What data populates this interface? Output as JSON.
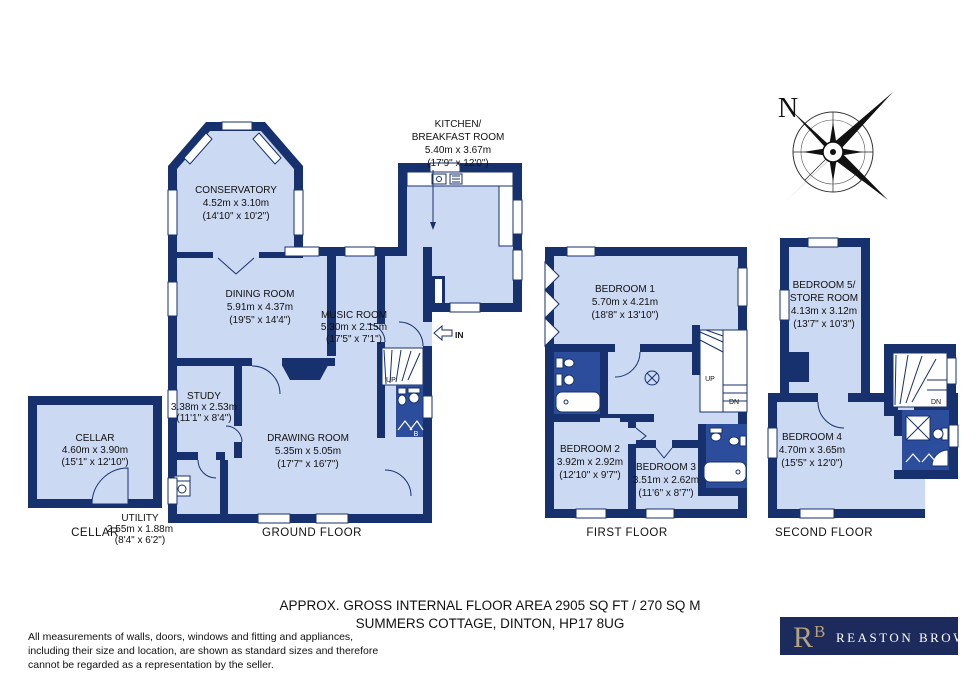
{
  "meta": {
    "footer1": "APPROX. GROSS INTERNAL FLOOR AREA 2905 SQ FT / 270 SQ M",
    "footer2": "SUMMERS COTTAGE, DINTON, HP17 8UG",
    "disc1": "All measurements of walls, doors, windows and fitting and appliances,",
    "disc2": "including their size and location, are shown as standard sizes and therefore",
    "disc3": "cannot be regarded as a representation by the seller."
  },
  "colors": {
    "wall": "#16316e",
    "room": "#ccd9f2",
    "wet_room": "#2b4d9c",
    "logo_bg": "#1d2a5c",
    "logo_gold": "#b3a27d"
  },
  "compass": {
    "n": "N"
  },
  "logo": {
    "r": "R",
    "b": "B",
    "name": "REASTON BROWN"
  },
  "cellar": {
    "label": "CELLAR",
    "room": {
      "name": "CELLAR",
      "m": "4.60m x 3.90m",
      "ft": "(15'1\" x 12'10\")"
    }
  },
  "ground": {
    "label": "GROUND FLOOR",
    "conservatory": {
      "name": "CONSERVATORY",
      "m": "4.52m x 3.10m",
      "ft": "(14'10\" x 10'2\")"
    },
    "kitchen": {
      "name1": "KITCHEN/",
      "name2": "BREAKFAST ROOM",
      "m": "5.40m x 3.67m",
      "ft": "(17'9\" x 12'0\")"
    },
    "dining": {
      "name": "DINING ROOM",
      "m": "5.91m x 4.37m",
      "ft": "(19'5\" x 14'4\")"
    },
    "music": {
      "name": "MUSIC ROOM",
      "m": "5.30m x 2.15m",
      "ft": "(17'5\" x 7'1\")"
    },
    "study": {
      "name": "STUDY",
      "m": "3.38m x 2.53m",
      "ft": "(11'1\" x 8'4\")"
    },
    "drawing": {
      "name": "DRAWING ROOM",
      "m": "5.35m x 5.05m",
      "ft": "(17'7\" x 16'7\")"
    },
    "utility": {
      "name": "UTILITY",
      "m": "2.55m x 1.88m",
      "ft": "(8'4\" x 6'2\")"
    },
    "up": "UP",
    "entrance": "IN",
    "boiler": "B"
  },
  "first": {
    "label": "FIRST FLOOR",
    "bedroom1": {
      "name": "BEDROOM 1",
      "m": "5.70m x 4.21m",
      "ft": "(18'8\" x 13'10\")"
    },
    "bedroom2": {
      "name": "BEDROOM 2",
      "m": "3.92m x 2.92m",
      "ft": "(12'10\" x 9'7\")"
    },
    "bedroom3": {
      "name": "BEDROOM 3",
      "m": "3.51m x 2.62m",
      "ft": "(11'6\" x 8'7\")"
    },
    "up": "UP",
    "dn": "DN"
  },
  "second": {
    "label": "SECOND FLOOR",
    "bedroom5": {
      "name1": "BEDROOM 5/",
      "name2": "STORE ROOM",
      "m": "4.13m x 3.12m",
      "ft": "(13'7\" x 10'3\")"
    },
    "bedroom4": {
      "name": "BEDROOM 4",
      "m": "4.70m x 3.65m",
      "ft": "(15'5\" x 12'0\")"
    },
    "dn": "DN"
  }
}
